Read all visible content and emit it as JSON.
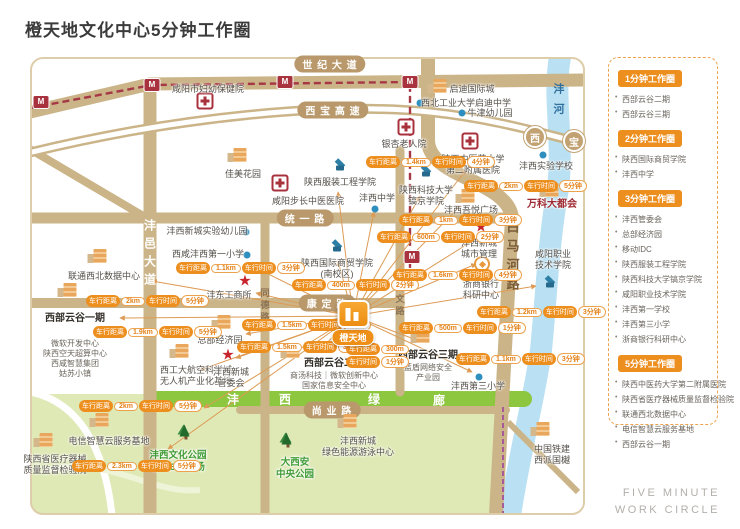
{
  "title": "橙天地文化中心5分钟工作圈",
  "footer": {
    "line1": "FIVE MINUTE",
    "line2": "WORK CIRCLE"
  },
  "colors": {
    "accent_orange": "#ed8f1f",
    "road_tan": "#cbb488",
    "metro_red": "#a8333f",
    "corridor_green": "#8dc63f",
    "river_blue": "#b9e1f3",
    "landmark_red": "#9e2b33"
  },
  "legend": {
    "sections": [
      {
        "header": "1分钟工作圈",
        "items": [
          "西部云谷二期",
          "西部云谷三期"
        ]
      },
      {
        "header": "2分钟工作圈",
        "items": [
          "陕西国际商贸学院",
          "沣西中学"
        ]
      },
      {
        "header": "3分钟工作圈",
        "items": [
          "沣西管委会",
          "总部经济园",
          "移动IDC",
          "陕西服装工程学院",
          "陕西科技大学镐京学院",
          "咸阳职业技术学院",
          "沣西第一学校",
          "沣西第三小学",
          "浙商银行科研中心"
        ]
      },
      {
        "header": "5分钟工作圈",
        "items": [
          "陕西中医药大学第二附属医院",
          "陕西省医疗器械质量监督检验院",
          "联通西北数据中心",
          "电信智慧云服务基地",
          "西部云谷一期"
        ]
      }
    ]
  },
  "map": {
    "center": {
      "x": 353,
      "y": 316,
      "label": "橙天地"
    },
    "station_glyph": "M",
    "badge_labels": {
      "dist": "车行距离",
      "time": "车行时间"
    },
    "road_labels": [
      {
        "type": "pill",
        "text": "世 纪 大 道",
        "x": 330,
        "y": 64
      },
      {
        "type": "pill",
        "text": "西 宝 高 速",
        "x": 333,
        "y": 110
      },
      {
        "type": "pill",
        "text": "统 一 路",
        "x": 305,
        "y": 218
      },
      {
        "type": "pill",
        "text": "康 定 路",
        "x": 327,
        "y": 303
      },
      {
        "type": "pill",
        "text": "尚 业 路",
        "x": 332,
        "y": 410
      },
      {
        "type": "vroad",
        "text": "沣邑大道",
        "x": 150,
        "y": 255
      },
      {
        "type": "vsmall",
        "text": "同德路",
        "x": 265,
        "y": 306
      },
      {
        "type": "vsmall",
        "text": "同文路",
        "x": 400,
        "y": 300
      },
      {
        "type": "vbig",
        "text": "白马河路",
        "x": 512,
        "y": 258
      },
      {
        "type": "river",
        "text": "沣河",
        "x": 558,
        "y": 103
      },
      {
        "type": "toll",
        "text": "西",
        "x": 535,
        "y": 137
      },
      {
        "type": "toll",
        "text": "宝",
        "x": 574,
        "y": 141
      },
      {
        "type": "corridor",
        "text": "沣",
        "x": 233,
        "y": 399
      },
      {
        "type": "corridor",
        "text": "西",
        "x": 285,
        "y": 399
      },
      {
        "type": "corridor",
        "text": "绿",
        "x": 374,
        "y": 399
      },
      {
        "type": "corridor",
        "text": "廊",
        "x": 439,
        "y": 400
      }
    ],
    "metro_stations": [
      [
        41,
        102
      ],
      [
        152,
        85
      ],
      [
        285,
        82
      ],
      [
        410,
        82
      ],
      [
        412,
        257
      ]
    ],
    "rays": [
      [
        152,
        281
      ],
      [
        120,
        318
      ],
      [
        254,
        267
      ],
      [
        256,
        293
      ],
      [
        246,
        334
      ],
      [
        236,
        358
      ],
      [
        204,
        408
      ],
      [
        168,
        449
      ],
      [
        338,
        192
      ],
      [
        338,
        261
      ],
      [
        374,
        212
      ],
      [
        420,
        196
      ],
      [
        460,
        206
      ],
      [
        466,
        170
      ],
      [
        477,
        238
      ],
      [
        476,
        264
      ],
      [
        536,
        286
      ],
      [
        422,
        342
      ],
      [
        472,
        372
      ],
      [
        322,
        348
      ],
      [
        200,
        370
      ]
    ],
    "pois": [
      {
        "id": "xianyang-maternity-hospital",
        "icon": "hospital",
        "ix": 205,
        "iy": 101,
        "lx": 208,
        "ly": 84,
        "lines": [
          "咸阳市妇幼保健院"
        ]
      },
      {
        "id": "qidi-international-city",
        "icon": "building",
        "ix": 440,
        "iy": 86,
        "lx": 472,
        "ly": 84,
        "lines": [
          "启迪国际城"
        ]
      },
      {
        "id": "nwpu-qidi-middle-school",
        "icon": "dot",
        "ix": 420,
        "iy": 103,
        "lx": 466,
        "ly": 98,
        "lines": [
          "西北工业大学启迪中学"
        ]
      },
      {
        "id": "oxford-kindergarten",
        "icon": "dot",
        "ix": 462,
        "iy": 113,
        "lx": 490,
        "ly": 108,
        "lines": [
          "牛津幼儿园"
        ]
      },
      {
        "id": "ginkgo-nursing-home",
        "icon": "hospital",
        "ix": 406,
        "iy": 127,
        "lx": 404,
        "ly": 139,
        "lines": [
          "银杏老人院"
        ]
      },
      {
        "id": "shaanxi-tcm-2nd-hospital",
        "icon": "hospital",
        "ix": 470,
        "iy": 141,
        "lx": 473,
        "ly": 154,
        "lines": [
          "陕西中医药大学",
          "第二附属医院"
        ]
      },
      {
        "id": "fengxi-experimental-school",
        "icon": "dot",
        "ix": 543,
        "iy": 155,
        "lx": 546,
        "ly": 161,
        "lines": [
          "沣西实验学校"
        ]
      },
      {
        "id": "vanke-metropolis",
        "icon": "building",
        "ix": 552,
        "iy": 190,
        "lx": 552,
        "ly": 199,
        "cls": "red",
        "lines": [
          "万科大都会"
        ]
      },
      {
        "id": "jiamei-garden",
        "icon": "building",
        "ix": 240,
        "iy": 155,
        "lx": 243,
        "ly": 169,
        "lines": [
          "佳美花园"
        ]
      },
      {
        "id": "buchang-tcm-hospital",
        "icon": "hospital",
        "ix": 280,
        "iy": 183,
        "lx": 308,
        "ly": 196,
        "lines": [
          "咸阳步长中医医院"
        ]
      },
      {
        "id": "shaanxi-fashion-engineering-college",
        "icon": "school",
        "ix": 340,
        "iy": 166,
        "lx": 340,
        "ly": 177,
        "lines": [
          "陕西服装工程学院"
        ]
      },
      {
        "id": "fengxi-middle-school",
        "icon": "dot",
        "ix": 375,
        "iy": 209,
        "lx": 377,
        "ly": 193,
        "lines": [
          "沣西中学"
        ]
      },
      {
        "id": "shaanxi-ust-haojing-college",
        "icon": "school",
        "ix": 426,
        "iy": 172,
        "lx": 426,
        "ly": 185,
        "lines": [
          "陕西科技大学",
          "镐京学院"
        ]
      },
      {
        "id": "fengxi-wuyue-plaza",
        "icon": "building",
        "ix": 468,
        "iy": 196,
        "lx": 471,
        "ly": 205,
        "lines": [
          "沣西吾悦广场"
        ]
      },
      {
        "id": "fengxi-experimental-kindergarten",
        "icon": "dot",
        "ix": 246,
        "iy": 232,
        "lx": 207,
        "ly": 226,
        "lines": [
          "沣西新城实验幼儿园"
        ]
      },
      {
        "id": "xixian-fengxi-first-primary",
        "icon": "dot",
        "ix": 247,
        "iy": 255,
        "lx": 208,
        "ly": 249,
        "lines": [
          "西咸沣西第一小学"
        ]
      },
      {
        "id": "fengdong-industry-commerce-office",
        "icon": "star",
        "ix": 245,
        "iy": 281,
        "lx": 229,
        "ly": 290,
        "lines": [
          "沣东工商所"
        ]
      },
      {
        "id": "unicom-nw-data-center",
        "icon": "building",
        "ix": 100,
        "iy": 256,
        "lx": 104,
        "ly": 271,
        "lines": [
          "联通西北数据中心"
        ]
      },
      {
        "id": "western-cloud-valley-phase1",
        "icon": "building",
        "ix": 70,
        "iy": 290,
        "lx": 75,
        "ly": 313,
        "cls": "bold",
        "lines": [
          "西部云谷一期"
        ],
        "sub": [
          "微软开发中心",
          "陕西空天超算中心",
          "西咸智慧集团",
          "姑苏小镇"
        ],
        "subgap": true
      },
      {
        "id": "headquarters-economy-park",
        "icon": "building",
        "ix": 224,
        "iy": 322,
        "lx": 220,
        "ly": 335,
        "lines": [
          "总部经济园"
        ]
      },
      {
        "id": "npu-aviation-uav-base",
        "icon": "building",
        "ix": 182,
        "iy": 351,
        "lx": 196,
        "ly": 365,
        "lines": [
          "西工大航空科学城",
          "无人机产业化基地"
        ]
      },
      {
        "id": "fengxi-new-city-admin-committee",
        "icon": "star",
        "ix": 228,
        "iy": 355,
        "lx": 231,
        "ly": 367,
        "lines": [
          "沣西新城",
          "管委会"
        ]
      },
      {
        "id": "western-cloud-valley-phase2",
        "icon": "building",
        "ix": 293,
        "iy": 351,
        "lx": 334,
        "ly": 358,
        "cls": "bold",
        "lines": [
          "西部云谷二期"
        ],
        "sub": [
          "商汤科技｜微软创新中心",
          "国家信息安全中心"
        ]
      },
      {
        "id": "western-cloud-valley-phase3",
        "icon": "building",
        "ix": 423,
        "iy": 336,
        "lx": 428,
        "ly": 350,
        "cls": "bold",
        "lines": [
          "西部云谷三期"
        ],
        "sub": [
          "蓝盾网络安全",
          "产业园"
        ]
      },
      {
        "id": "fengxi-third-primary",
        "icon": "dot",
        "ix": 479,
        "iy": 377,
        "lx": 478,
        "ly": 381,
        "lines": [
          "沣西第三小学"
        ]
      },
      {
        "id": "xianyang-vocational-college",
        "icon": "school",
        "ix": 550,
        "iy": 283,
        "lx": 553,
        "ly": 249,
        "lines": [
          "咸阳职业",
          "技术学院"
        ]
      },
      {
        "id": "zheshang-bank-rd-center",
        "icon": "bank",
        "ix": 482,
        "iy": 264,
        "lx": 481,
        "ly": 279,
        "lines": [
          "浙商银行",
          "科研中心"
        ]
      },
      {
        "id": "fengxi-city-management",
        "icon": "star",
        "ix": 481,
        "iy": 227,
        "lx": 479,
        "ly": 238,
        "lines": [
          "沣西新城",
          "城市管理"
        ]
      },
      {
        "id": "telecom-smart-cloud-base",
        "icon": "building",
        "ix": 102,
        "iy": 420,
        "lx": 109,
        "ly": 436,
        "lines": [
          "电信智慧云服务基地"
        ]
      },
      {
        "id": "medical-device-inspection-institute",
        "icon": "building",
        "ix": 46,
        "iy": 440,
        "lx": 55,
        "ly": 454,
        "lines": [
          "陕西省医疗器械",
          "质量监督检验院"
        ]
      },
      {
        "id": "fengxi-culture-park",
        "icon": "tree",
        "ix": 186,
        "iy": 436,
        "lx": 178,
        "ly": 450,
        "cls": "green",
        "lines": [
          "沣西文化公园",
          "橙天360剧场"
        ]
      },
      {
        "id": "daxian-central-park",
        "icon": "tree",
        "ix": 288,
        "iy": 444,
        "lx": 295,
        "ly": 457,
        "cls": "green",
        "lines": [
          "大西安",
          "中央公园"
        ]
      },
      {
        "id": "fengxi-green-energy-swim-center",
        "icon": "building",
        "ix": 350,
        "iy": 421,
        "lx": 358,
        "ly": 436,
        "lines": [
          "沣西新城",
          "绿色能源游泳中心"
        ]
      },
      {
        "id": "crcc-xipai-guoyue",
        "icon": "building",
        "ix": 543,
        "iy": 429,
        "lx": 552,
        "ly": 444,
        "lines": [
          "中国铁建",
          "西派国樾"
        ]
      },
      {
        "id": "shaanxi-intl-business-college",
        "icon": "school",
        "ix": 337,
        "iy": 247,
        "lx": 337,
        "ly": 258,
        "lines": [
          "陕西国际商贸学院",
          "(南校区)"
        ]
      }
    ],
    "badges": [
      {
        "x": 86,
        "y": 295,
        "d": "2km",
        "t": "5分钟"
      },
      {
        "x": 93,
        "y": 326,
        "d": "1.9km",
        "t": "5分钟"
      },
      {
        "x": 176,
        "y": 262,
        "d": "1.1km",
        "t": "3分钟"
      },
      {
        "x": 242,
        "y": 319,
        "d": "1.5km",
        "t": "3分钟"
      },
      {
        "x": 237,
        "y": 341,
        "d": "1.5km",
        "t": "3分钟"
      },
      {
        "x": 366,
        "y": 156,
        "d": "1.4km",
        "t": "4分钟"
      },
      {
        "x": 292,
        "y": 279,
        "d": "400m",
        "t": "2分钟"
      },
      {
        "x": 377,
        "y": 231,
        "d": "600m",
        "t": "2分钟"
      },
      {
        "x": 399,
        "y": 214,
        "d": "1km",
        "t": "3分钟"
      },
      {
        "x": 464,
        "y": 180,
        "d": "2km",
        "t": "5分钟"
      },
      {
        "x": 393,
        "y": 269,
        "d": "1.6km",
        "t": "4分钟"
      },
      {
        "x": 477,
        "y": 306,
        "d": "1.2km",
        "t": "3分钟"
      },
      {
        "x": 399,
        "y": 322,
        "d": "500m",
        "t": "1分钟"
      },
      {
        "x": 346,
        "y": 343,
        "d": "300m",
        "t": "1分钟",
        "stack": true
      },
      {
        "x": 79,
        "y": 400,
        "d": "2km",
        "t": "5分钟"
      },
      {
        "x": 72,
        "y": 460,
        "d": "2.3km",
        "t": "5分钟"
      },
      {
        "x": 456,
        "y": 353,
        "d": "1.1km",
        "t": "3分钟"
      }
    ]
  }
}
